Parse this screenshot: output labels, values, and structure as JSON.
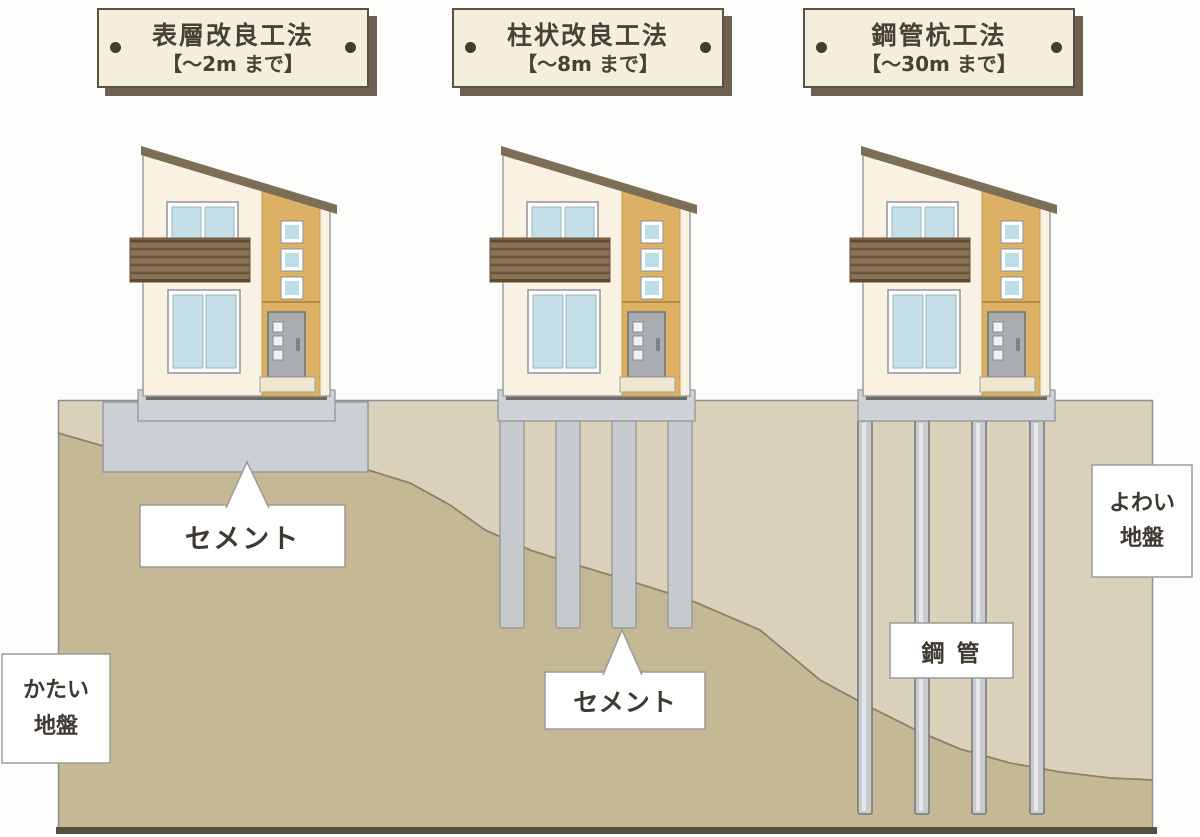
{
  "signs": [
    {
      "title": "表層改良工法",
      "range": "【～2m まで】"
    },
    {
      "title": "柱状改良工法",
      "range": "【～8m まで】"
    },
    {
      "title": "鋼管杭工法",
      "range": "【～30m まで】"
    }
  ],
  "labels": {
    "cement_1": "セメント",
    "cement_2": "セメント",
    "steel_pipe": "鋼 管",
    "weak_ground": "よわい\n地盤",
    "hard_ground": "かたい\n地盤"
  },
  "colors": {
    "sign_bg": "#f4eedd",
    "sign_border": "#5a5243",
    "sign_shadow": "#6f6152",
    "ground_weak": "#d9d1b9",
    "ground_hard": "#c5b995",
    "ground_boundary_line": "#8d8166",
    "ground_bottom_bar": "#55513f",
    "cement_gray": "#cbced3",
    "pile_gray": "#c6c9ce",
    "steel_pipe_gray": "#c9cbce",
    "house_wall": "#f9f2e3",
    "house_accent_panel": "#dcb164",
    "roof_brown": "#7d6e58",
    "balcony_brown": "#8a7158",
    "window_blue": "#c4dfe7",
    "door_gray": "#a9adb2"
  }
}
